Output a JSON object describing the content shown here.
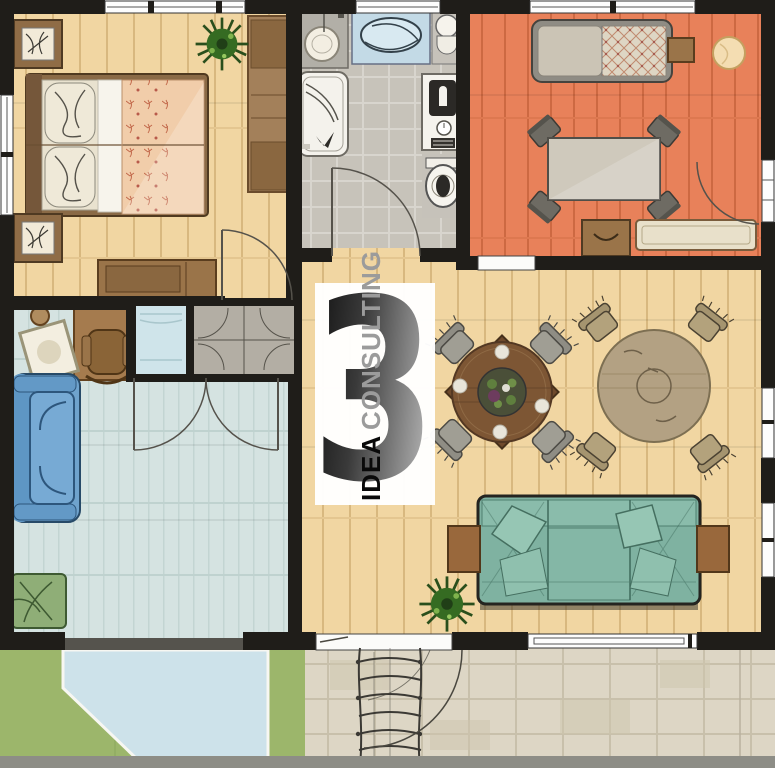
{
  "watermark": {
    "number": "3",
    "word_primary": "IDEA",
    "word_secondary": "CONSULTING"
  },
  "palette": {
    "wall": "#1f1d19",
    "wood_floor": "#f1d6a2",
    "orange_room_floor": "#e8815a",
    "bathroom_floor": "#c7c3ba",
    "office_room_floor": "#d5e3e1",
    "grass": "#9cb66b",
    "patio": "#cde2ea",
    "terrace": "#ddd6c5",
    "teal_sofa": "#7fb2a1",
    "blue_sofa": "#6fa3cd",
    "green_armchair": "#8fae77",
    "dining_table_dark": "#7d5634",
    "dining_table_tan": "#b3a183",
    "bed_blanket": "#f1cdaa",
    "watermark_number_dark": "#0d0d0d",
    "watermark_number_light": "#a9a9a9"
  }
}
